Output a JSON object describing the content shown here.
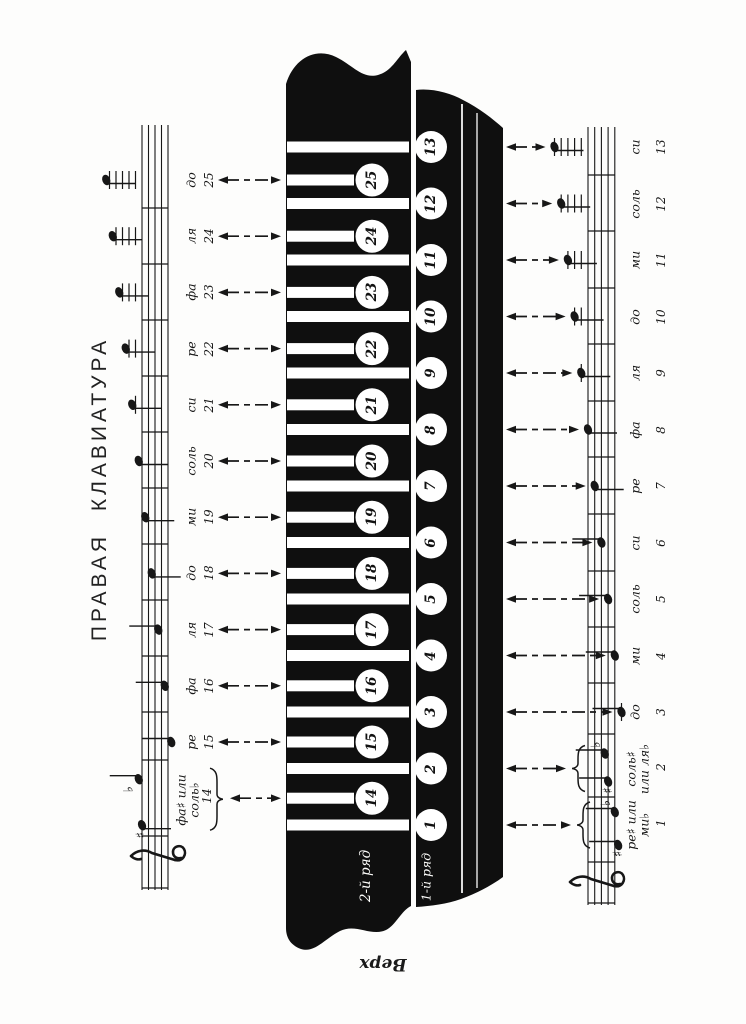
{
  "page": {
    "title": "ПРАВАЯ КЛАВИАТУРА",
    "bottom_label": "Верх",
    "paper_color": "#fdfdfc",
    "ink_color": "#171717",
    "keyboard_color": "#0f0f0f"
  },
  "keyboard": {
    "row2_label": "2-й ряд",
    "row1_label": "1-й ряд",
    "row1_buttons": [
      "1",
      "2",
      "3",
      "4",
      "5",
      "6",
      "7",
      "8",
      "9",
      "10",
      "11",
      "12",
      "13"
    ],
    "row2_buttons": [
      "14",
      "15",
      "16",
      "17",
      "18",
      "19",
      "20",
      "21",
      "22",
      "23",
      "24",
      "25"
    ]
  },
  "left_column": {
    "notes": [
      {
        "num": "25",
        "name": "до",
        "staff_pos": -11
      },
      {
        "num": "24",
        "name": "ля",
        "staff_pos": -9
      },
      {
        "num": "23",
        "name": "фа",
        "staff_pos": -7
      },
      {
        "num": "22",
        "name": "ре",
        "staff_pos": -5
      },
      {
        "num": "21",
        "name": "си",
        "staff_pos": -3
      },
      {
        "num": "20",
        "name": "соль",
        "staff_pos": -1
      },
      {
        "num": "19",
        "name": "ми",
        "staff_pos": 1
      },
      {
        "num": "18",
        "name": "до",
        "staff_pos": 3
      },
      {
        "num": "17",
        "name": "ля",
        "staff_pos": 5
      },
      {
        "num": "16",
        "name": "фа",
        "staff_pos": 7
      },
      {
        "num": "15",
        "name": "ре",
        "staff_pos": 9
      },
      {
        "num": "14",
        "name_lines": [
          "фа♯ или",
          "соль♭"
        ],
        "bracket": true,
        "pitches": [
          {
            "accidental": "♭",
            "staff_pos": -1
          },
          {
            "accidental": "♯",
            "staff_pos": 0
          }
        ]
      }
    ]
  },
  "right_column": {
    "notes": [
      {
        "num": "13",
        "name": "си",
        "staff_pos": -10
      },
      {
        "num": "12",
        "name": "соль",
        "staff_pos": -8
      },
      {
        "num": "11",
        "name": "ми",
        "staff_pos": -6
      },
      {
        "num": "10",
        "name": "до",
        "staff_pos": -4
      },
      {
        "num": "9",
        "name": "ля",
        "staff_pos": -2
      },
      {
        "num": "8",
        "name": "фа",
        "staff_pos": 0
      },
      {
        "num": "7",
        "name": "ре",
        "staff_pos": 2
      },
      {
        "num": "6",
        "name": "си",
        "staff_pos": 4
      },
      {
        "num": "5",
        "name": "соль",
        "staff_pos": 6
      },
      {
        "num": "4",
        "name": "ми",
        "staff_pos": 8
      },
      {
        "num": "3",
        "name": "до",
        "staff_pos": 10
      },
      {
        "num": "2",
        "name_lines": [
          "соль♯",
          "или ля♭"
        ],
        "bracket": true,
        "pitches": [
          {
            "accidental": "♭",
            "staff_pos": 5
          },
          {
            "accidental": "♯",
            "staff_pos": 6
          }
        ]
      },
      {
        "num": "1",
        "name_lines": [
          "ре♯ или",
          "ми♭"
        ],
        "bracket": true,
        "pitches": [
          {
            "accidental": "♭",
            "staff_pos": 8
          },
          {
            "accidental": "♯",
            "staff_pos": 9
          }
        ]
      }
    ]
  }
}
